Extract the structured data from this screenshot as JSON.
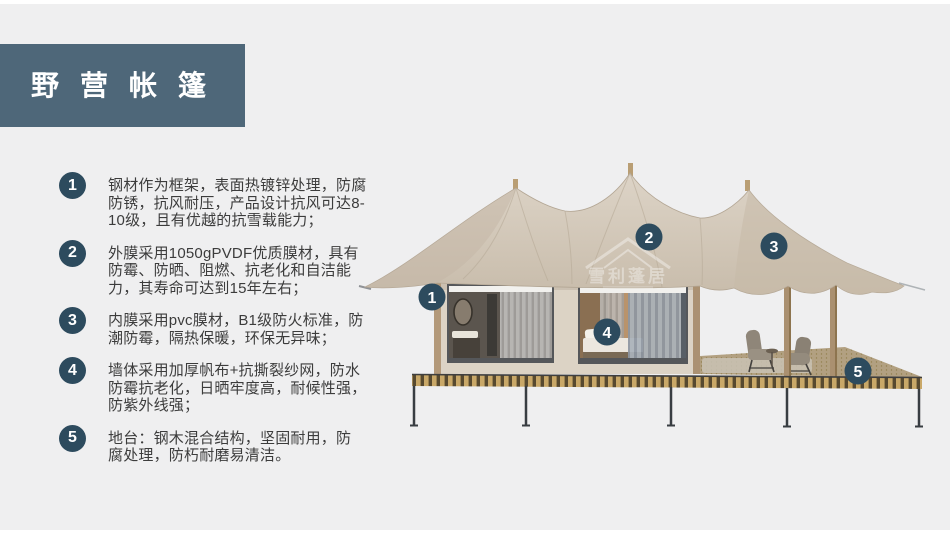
{
  "slide": {
    "title": "野营帐篷"
  },
  "features": [
    {
      "num": "1",
      "text": "钢材作为框架，表面热镀锌处理，防腐\n防锈，抗风耐压，产品设计抗风可达8-\n10级，且有优越的抗雪载能力；"
    },
    {
      "num": "2",
      "text": "外膜采用1050gPVDF优质膜材，具有\n防霉、防晒、阻燃、抗老化和自洁能\n力，其寿命可达到15年左右；"
    },
    {
      "num": "3",
      "text": "内膜采用pvc膜材，B1级防火标准，防\n潮防霉，隔热保暖，环保无异味；"
    },
    {
      "num": "4",
      "text": "墙体采用加厚帆布+抗撕裂纱网，防水\n防霉抗老化，日晒牢度高，耐候性强，\n防紫外线强；"
    },
    {
      "num": "5",
      "text": "地台：钢木混合结构，坚固耐用，防\n腐处理，防朽耐磨易清洁。"
    }
  ],
  "image_badges": [
    {
      "num": "1"
    },
    {
      "num": "2"
    },
    {
      "num": "3"
    },
    {
      "num": "4"
    },
    {
      "num": "5"
    }
  ],
  "watermark": {
    "text": "雪利蓬居"
  },
  "colors": {
    "background": "#efeff0",
    "title_bar": "#4e6779",
    "badge": "#2d4b5e",
    "canopy": "#d2c8ba",
    "wall": "#dcd3c5",
    "deck_plank": "#c9a868",
    "body_text": "#3c3c3c"
  }
}
